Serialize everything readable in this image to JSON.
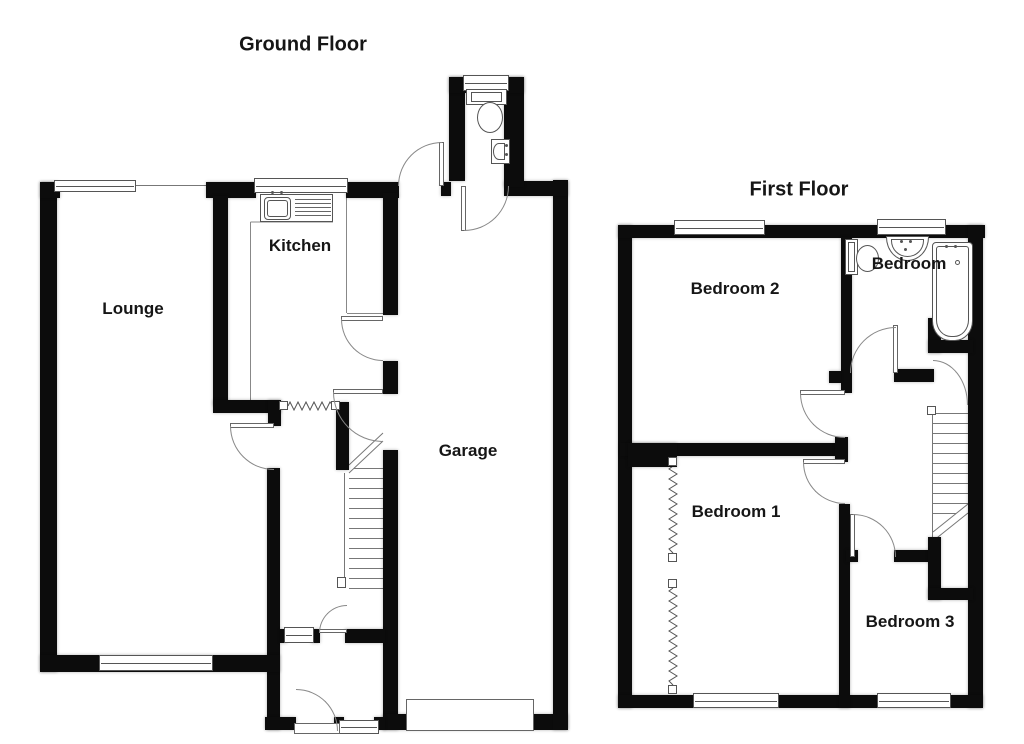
{
  "floors": {
    "ground": {
      "title": "Ground Floor",
      "rooms": {
        "lounge": "Lounge",
        "kitchen": "Kitchen",
        "garage": "Garage"
      }
    },
    "first": {
      "title": "First Floor",
      "rooms": {
        "bedroom2": "Bedroom 2",
        "bathroom_label": "Bedroom",
        "bedroom1": "Bedroom 1",
        "bedroom3": "Bedroom 3"
      }
    }
  },
  "icons": {
    "toilet": "toilet-icon",
    "sink": "sink-icon",
    "bathtub": "bathtub-icon",
    "kitchen_sink": "kitchen-sink-icon",
    "staircase": "staircase-icon",
    "door_swing": "door-swing-icon",
    "window": "window-icon",
    "wall_break": "wall-break-icon"
  },
  "colors": {
    "wall": "#0c0c0c",
    "thin_line": "#666666",
    "text": "#161616",
    "background": "#ffffff"
  }
}
